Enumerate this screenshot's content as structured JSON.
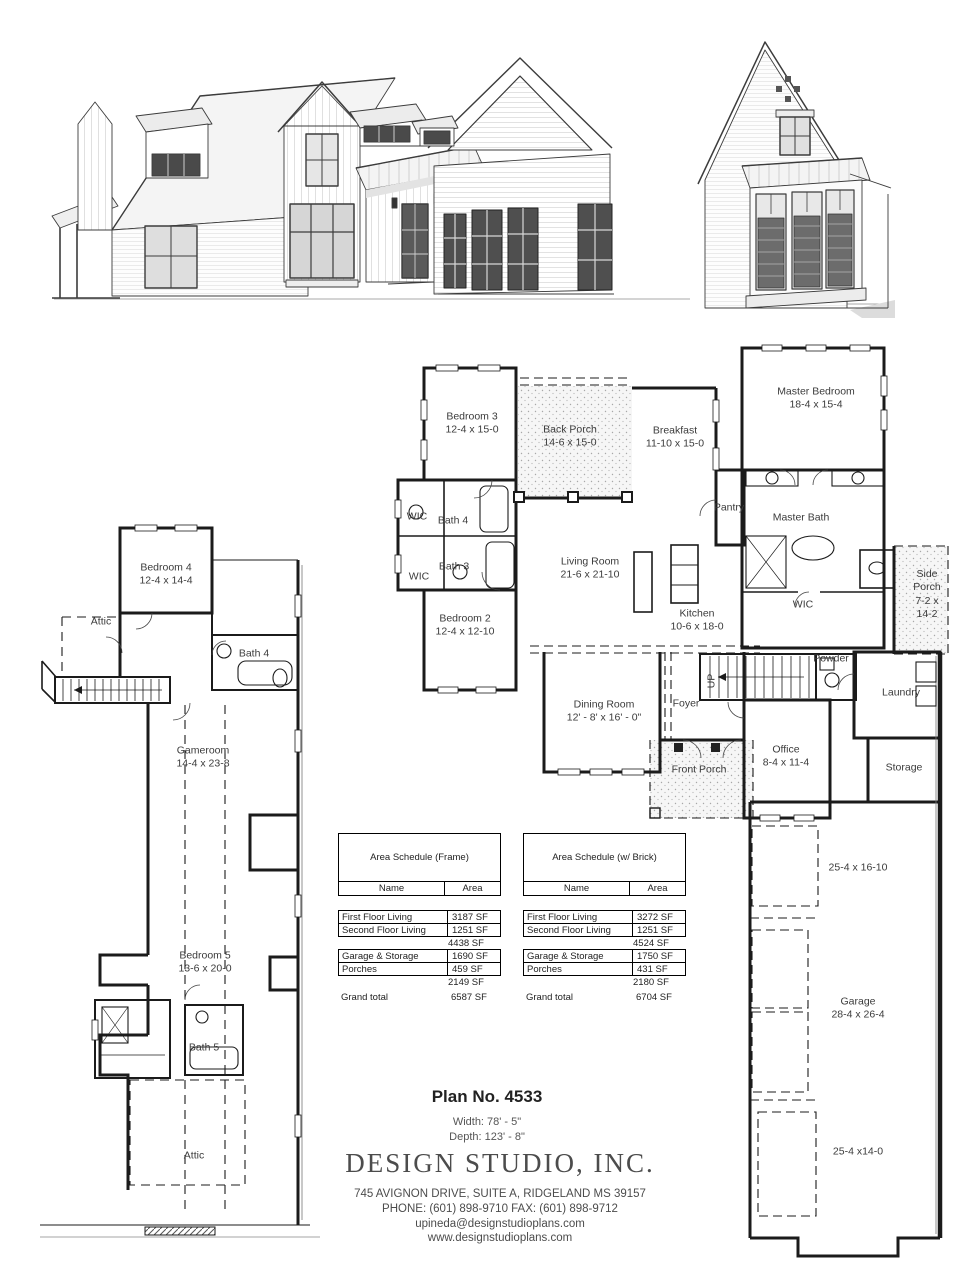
{
  "title_block": {
    "plan_no": "Plan No. 4533",
    "width": "Width: 78' - 5\"",
    "depth": "Depth: 123' - 8\"",
    "company_name": "DESIGN STUDIO, INC.",
    "company_address": "745 AVIGNON DRIVE, SUITE A, RIDGELAND MS 39157",
    "company_phone_fax": "PHONE: (601) 898-9710  FAX: (601) 898-9712",
    "company_email": "upineda@designstudioplans.com",
    "company_website": "www.designstudioplans.com"
  },
  "first_floor": {
    "rooms": [
      {
        "lines": [
          "Bedroom 3",
          "12-4 x 15-0"
        ],
        "x": 472,
        "y": 424
      },
      {
        "lines": [
          "Back Porch",
          "14-6 x 15-0"
        ],
        "x": 570,
        "y": 437
      },
      {
        "lines": [
          "Breakfast",
          "11-10 x 15-0"
        ],
        "x": 675,
        "y": 438
      },
      {
        "lines": [
          "Master Bedroom",
          "18-4 x 15-4"
        ],
        "x": 816,
        "y": 399
      },
      {
        "lines": [
          "WIC"
        ],
        "x": 417,
        "y": 517
      },
      {
        "lines": [
          "Bath 4"
        ],
        "x": 453,
        "y": 521
      },
      {
        "lines": [
          "Bath 3"
        ],
        "x": 454,
        "y": 567
      },
      {
        "lines": [
          "WIC"
        ],
        "x": 419,
        "y": 577
      },
      {
        "lines": [
          "Pantry"
        ],
        "x": 729,
        "y": 508
      },
      {
        "lines": [
          "Master Bath"
        ],
        "x": 801,
        "y": 518
      },
      {
        "lines": [
          "Living Room",
          "21-6 x 21-10"
        ],
        "x": 590,
        "y": 569
      },
      {
        "lines": [
          "Bedroom 2",
          "12-4 x 12-10"
        ],
        "x": 465,
        "y": 626
      },
      {
        "lines": [
          "Kitchen",
          "10-6 x 18-0"
        ],
        "x": 697,
        "y": 621
      },
      {
        "lines": [
          "WIC"
        ],
        "x": 803,
        "y": 605
      },
      {
        "lines": [
          "Side",
          "Porch",
          "7-2 x",
          "14-2"
        ],
        "x": 927,
        "y": 595
      },
      {
        "lines": [
          "Powder"
        ],
        "x": 831,
        "y": 659
      },
      {
        "lines": [
          "UP"
        ],
        "x": 712,
        "y": 681,
        "rotate": -90
      },
      {
        "lines": [
          "Laundry"
        ],
        "x": 901,
        "y": 693
      },
      {
        "lines": [
          "Dining Room",
          "12' - 8' x 16' - 0\""
        ],
        "x": 604,
        "y": 712
      },
      {
        "lines": [
          "Foyer"
        ],
        "x": 686,
        "y": 704
      },
      {
        "lines": [
          "Front Porch"
        ],
        "x": 699,
        "y": 770
      },
      {
        "lines": [
          "Office",
          "8-4 x 11-4"
        ],
        "x": 786,
        "y": 757
      },
      {
        "lines": [
          "Storage"
        ],
        "x": 904,
        "y": 768
      },
      {
        "lines": [
          "25-4 x 16-10"
        ],
        "x": 858,
        "y": 868
      },
      {
        "lines": [
          "Garage",
          "28-4 x 26-4"
        ],
        "x": 858,
        "y": 1009
      },
      {
        "lines": [
          "25-4 x14-0"
        ],
        "x": 858,
        "y": 1152
      }
    ]
  },
  "second_floor": {
    "rooms": [
      {
        "lines": [
          "Bedroom 4",
          "12-4 x 14-4"
        ],
        "x": 166,
        "y": 575
      },
      {
        "lines": [
          "Attic"
        ],
        "x": 101,
        "y": 622
      },
      {
        "lines": [
          "Bath 4"
        ],
        "x": 254,
        "y": 654
      },
      {
        "lines": [
          "Gameroom",
          "14-4 x 23-8"
        ],
        "x": 203,
        "y": 758
      },
      {
        "lines": [
          "Bedroom 5",
          "13-6 x 20-0"
        ],
        "x": 205,
        "y": 963
      },
      {
        "lines": [
          "Bath 5"
        ],
        "x": 204,
        "y": 1048
      },
      {
        "lines": [
          "Attic"
        ],
        "x": 194,
        "y": 1156
      }
    ]
  },
  "area_schedules": [
    {
      "title": "Area Schedule (Frame)",
      "columns": [
        "Name",
        "Area"
      ],
      "x": 338,
      "y": 833,
      "groups": [
        {
          "rows": [
            [
              "First Floor Living",
              "3187 SF"
            ],
            [
              "Second Floor Living",
              "1251 SF"
            ]
          ],
          "subtotal": "4438 SF"
        },
        {
          "rows": [
            [
              "Garage & Storage",
              "1690 SF"
            ],
            [
              "Porches",
              "459 SF"
            ]
          ],
          "subtotal": "2149 SF"
        }
      ],
      "grand_total_label": "Grand total",
      "grand_total": "6587 SF"
    },
    {
      "title": "Area Schedule (w/ Brick)",
      "columns": [
        "Name",
        "Area"
      ],
      "x": 523,
      "y": 833,
      "groups": [
        {
          "rows": [
            [
              "First Floor Living",
              "3272 SF"
            ],
            [
              "Second Floor Living",
              "1251 SF"
            ]
          ],
          "subtotal": "4524 SF"
        },
        {
          "rows": [
            [
              "Garage & Storage",
              "1750 SF"
            ],
            [
              "Porches",
              "431 SF"
            ]
          ],
          "subtotal": "2180 SF"
        }
      ],
      "grand_total_label": "Grand total",
      "grand_total": "6704 SF"
    }
  ]
}
